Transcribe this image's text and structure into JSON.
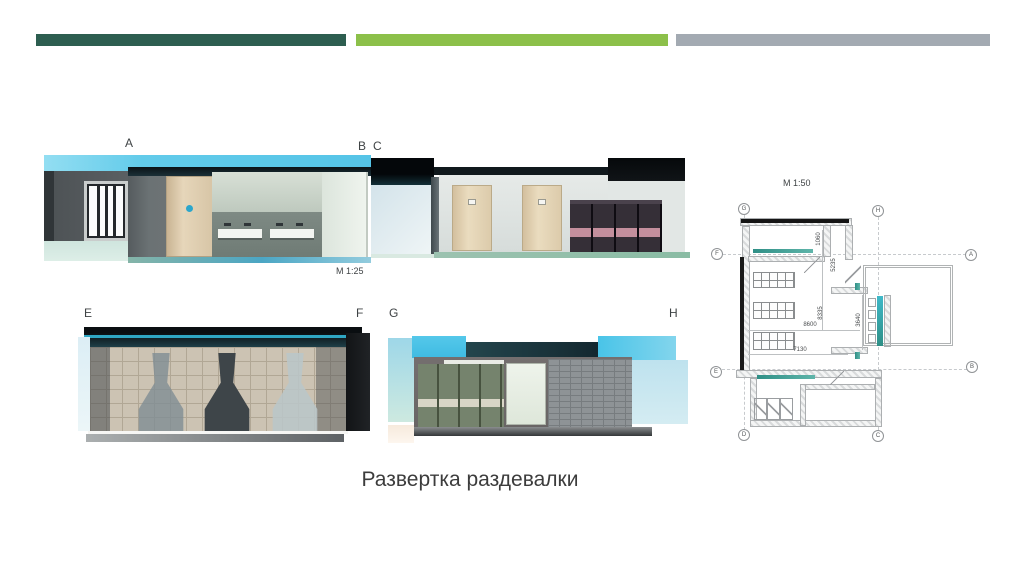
{
  "slide": {
    "title": "Развертка раздевалки"
  },
  "accent_bars": {
    "bar1": "#2D5E50",
    "bar2": "#8CC04A",
    "bar3": "#A3AAB2"
  },
  "elevations": {
    "ab": {
      "start": "A",
      "end": "B",
      "scale": "М 1:25"
    },
    "cd": {
      "start": "C"
    },
    "ef": {
      "start": "E",
      "end": "F"
    },
    "gh": {
      "start": "G",
      "end": "H"
    }
  },
  "plan": {
    "scale": "М 1:50",
    "bubbles": [
      {
        "label": "G"
      },
      {
        "label": "H"
      },
      {
        "label": "F"
      },
      {
        "label": "A"
      },
      {
        "label": "E"
      },
      {
        "label": "B"
      },
      {
        "label": "D"
      },
      {
        "label": "C"
      }
    ],
    "dimensions": [
      {
        "value": "1060"
      },
      {
        "value": "5235"
      },
      {
        "value": "8335"
      },
      {
        "value": "8600"
      },
      {
        "value": "7130"
      },
      {
        "value": "3640"
      }
    ]
  }
}
